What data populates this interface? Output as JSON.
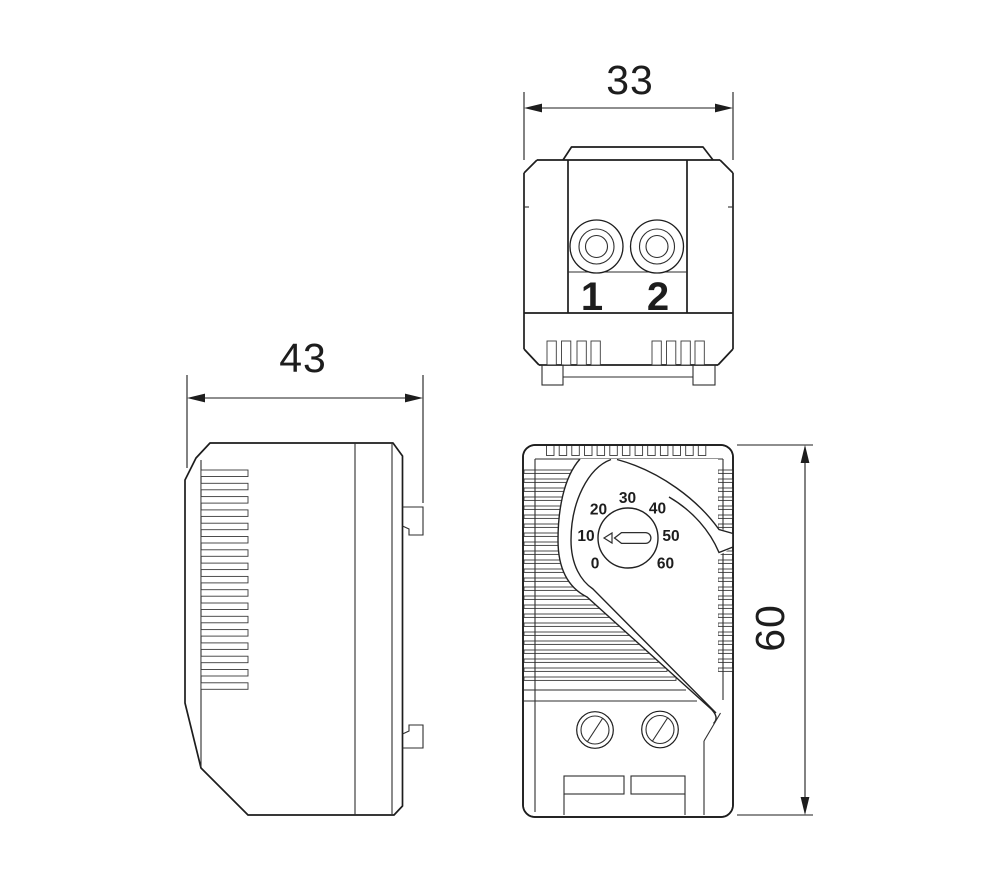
{
  "drawing": {
    "background": "#ffffff",
    "line_color": "#1d1d1d",
    "dims": {
      "top_width": "33",
      "side_depth": "43",
      "front_height": "60"
    },
    "terminals": {
      "t1": "1",
      "t2": "2"
    },
    "dial": {
      "scale": [
        "0",
        "10",
        "20",
        "30",
        "40",
        "50",
        "60"
      ]
    }
  }
}
